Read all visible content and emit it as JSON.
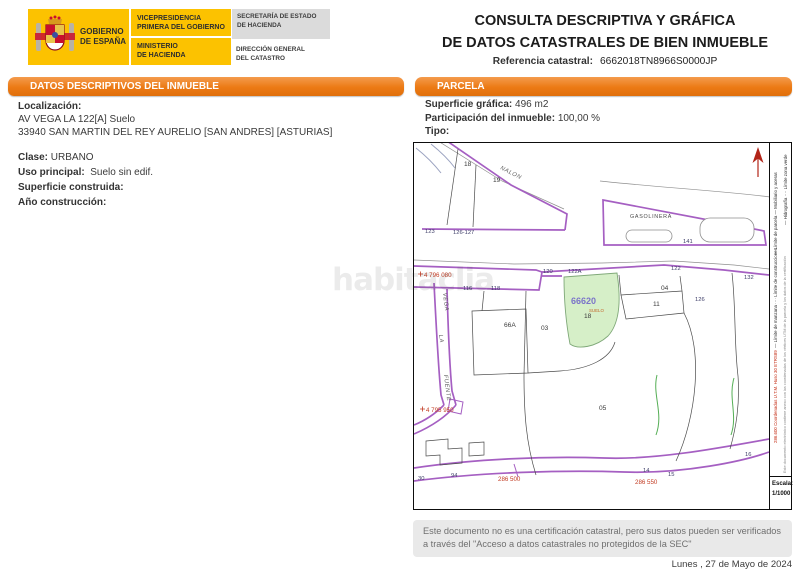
{
  "header": {
    "gobierno": "GOBIERNO\nDE ESPAÑA",
    "vicepresidencia": "VICEPRESIDENCIA\nPRIMERA DEL GOBIERNO",
    "ministerio": "MINISTERIO\nDE HACIENDA",
    "secretaria": "SECRETARÍA DE ESTADO\nDE HACIENDA",
    "direccion": "DIRECCIÓN GENERAL\nDEL CATASTRO",
    "title": "CONSULTA DESCRIPTIVA Y GRÁFICA\nDE DATOS CATASTRALES DE BIEN INMUEBLE",
    "ref_label": "Referencia catastral:",
    "ref_value": "6662018TN8966S0000JP"
  },
  "inmueble": {
    "section_title": "DATOS DESCRIPTIVOS DEL INMUEBLE",
    "localizacion_label": "Localización:",
    "localizacion": "AV VEGA LA 122[A] Suelo\n33940 SAN MARTIN DEL REY AURELIO [SAN ANDRES] [ASTURIAS]",
    "clase_label": "Clase:",
    "clase": "URBANO",
    "uso_label": "Uso principal:",
    "uso": "Suelo sin edif.",
    "superficie_label": "Superficie construida:",
    "superficie": "",
    "anio_label": "Año construcción:",
    "anio": ""
  },
  "parcela": {
    "section_title": "PARCELA",
    "sup_grafica_label": "Superficie gráfica:",
    "sup_grafica": "496 m2",
    "participacion_label": "Participación del inmueble:",
    "participacion": "100,00 %",
    "tipo_label": "Tipo:",
    "tipo": ""
  },
  "map": {
    "watermark": "habitaclia",
    "scale_label": "Escala:",
    "scale_value": "1/1000",
    "legend": {
      "inner_top": "— Límite de parcela      — Mobiliario y aceras",
      "inner_mid": "— Límite de manzana      ···· Límite de construcciones",
      "coords_note": "286.600 Coordenadas U.T.M. Huso 30 ETRS89",
      "outer_top": "— Hidrografía      ···· Límite zona verde",
      "cert_note": "Este documento electrónico contiene anexo con las coordenadas de los vértices UTM de la parcela y los datos de la certificación"
    },
    "labels": [
      {
        "t": "18",
        "x": 50,
        "y": 23,
        "c": "num"
      },
      {
        "t": "19",
        "x": 79,
        "y": 39,
        "c": "num"
      },
      {
        "t": "NALON",
        "x": 86,
        "y": 26,
        "c": "street",
        "r": 27
      },
      {
        "t": "123",
        "x": 11,
        "y": 90,
        "c": "addr"
      },
      {
        "t": "126-127",
        "x": 39,
        "y": 91,
        "c": "addr"
      },
      {
        "t": "GASOLINERA",
        "x": 216,
        "y": 75,
        "c": "place"
      },
      {
        "t": "141",
        "x": 269,
        "y": 100,
        "c": "addr"
      },
      {
        "t": "120",
        "x": 129,
        "y": 130,
        "c": "addr"
      },
      {
        "t": "122A",
        "x": 154,
        "y": 130,
        "c": "addr"
      },
      {
        "t": "122",
        "x": 257,
        "y": 127,
        "c": "addr"
      },
      {
        "t": "132",
        "x": 330,
        "y": 136,
        "c": "addr"
      },
      {
        "t": "04",
        "x": 247,
        "y": 147,
        "c": "num"
      },
      {
        "t": "11",
        "x": 239,
        "y": 163,
        "c": "num"
      },
      {
        "t": "126",
        "x": 281,
        "y": 158,
        "c": "addr"
      },
      {
        "t": "116",
        "x": 49,
        "y": 147,
        "c": "addr"
      },
      {
        "t": "118",
        "x": 77,
        "y": 147,
        "c": "addr"
      },
      {
        "t": "66A",
        "x": 90,
        "y": 184,
        "c": "num"
      },
      {
        "t": "03",
        "x": 127,
        "y": 187,
        "c": "num"
      },
      {
        "t": "66620",
        "x": 157,
        "y": 161,
        "c": "ref"
      },
      {
        "t": "SUELO",
        "x": 175,
        "y": 169,
        "c": "suelo"
      },
      {
        "t": "18",
        "x": 170,
        "y": 175,
        "c": "num"
      },
      {
        "t": "05",
        "x": 185,
        "y": 267,
        "c": "num"
      },
      {
        "t": "VEGA",
        "x": 29,
        "y": 150,
        "c": "street",
        "r": 83
      },
      {
        "t": "LA",
        "x": 25,
        "y": 192,
        "c": "street",
        "r": 83
      },
      {
        "t": "FUENTE",
        "x": 30,
        "y": 232,
        "c": "street",
        "r": 83
      },
      {
        "t": "30",
        "x": 4,
        "y": 337,
        "c": "addr"
      },
      {
        "t": "94",
        "x": 37,
        "y": 334,
        "c": "addr"
      },
      {
        "t": "14",
        "x": 229,
        "y": 329,
        "c": "addr"
      },
      {
        "t": "15",
        "x": 254,
        "y": 333,
        "c": "addr"
      },
      {
        "t": "16",
        "x": 331,
        "y": 313,
        "c": "addr"
      },
      {
        "t": "4 796 080",
        "x": 10,
        "y": 134,
        "c": "coord"
      },
      {
        "t": "4 795 950",
        "x": 12,
        "y": 269,
        "c": "coord"
      },
      {
        "t": "286 500",
        "x": 84,
        "y": 338,
        "c": "coord"
      },
      {
        "t": "286 550",
        "x": 221,
        "y": 341,
        "c": "coord"
      }
    ]
  },
  "footer": {
    "note": "Este documento no es una certificación catastral, pero sus datos pueden ser verificados a través del \"Acceso a datos catastrales no protegidos de la SEC\"",
    "date": "Lunes , 27 de Mayo de 2024"
  }
}
